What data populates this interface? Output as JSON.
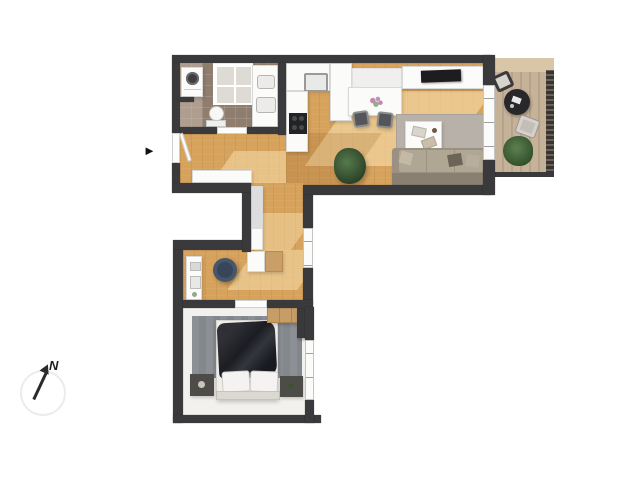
{
  "compass": {
    "north_label": "N"
  },
  "icons": {
    "entrance_arrow": "►"
  },
  "colors": {
    "wall": "#3a3a3c",
    "wood": "#d6a25c",
    "wood_light": "#ecc98d",
    "tile": "#8f7d6e",
    "bedroom_floor": "#f3f1ee",
    "deck": "#c6b299",
    "rug_living": "#b7b1a9",
    "rug_bedroom": "#83888d",
    "blanket": "#23252b",
    "sofa": "#9b9183",
    "plant": "#3a5434",
    "chair_accent": "#47566b",
    "railing": "#4a443e"
  }
}
